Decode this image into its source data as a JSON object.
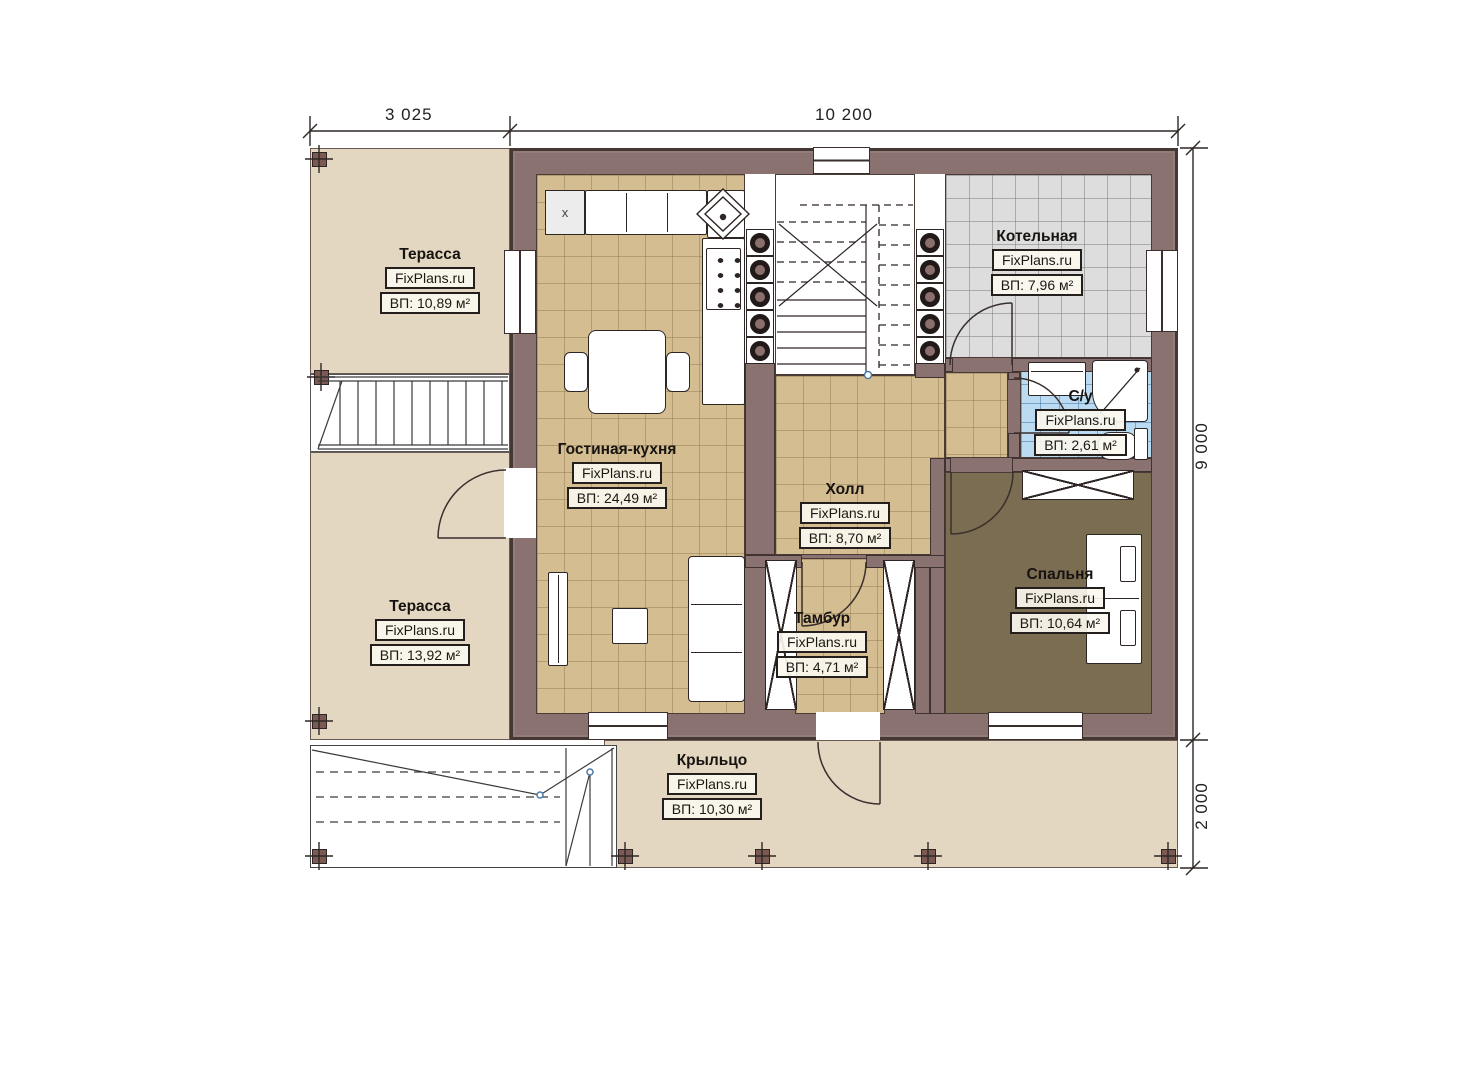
{
  "plan": {
    "watermark": "FixPlans.ru",
    "kitchen_mark": "x",
    "dims": {
      "top_left": "3 025",
      "top_right": "10 200",
      "right_upper": "9 000",
      "right_lower": "2 000"
    },
    "rooms": [
      {
        "name": "Терасса",
        "area": "ВП: 10,89 м²"
      },
      {
        "name": "Котельная",
        "area": "ВП: 7,96 м²"
      },
      {
        "name": "Гостиная-кухня",
        "area": "ВП: 24,49 м²"
      },
      {
        "name": "Холл",
        "area": "ВП: 8,70 м²"
      },
      {
        "name": "С/у",
        "area": "ВП: 2,61 м²"
      },
      {
        "name": "Терасса",
        "area": "ВП: 13,92 м²"
      },
      {
        "name": "Тамбур",
        "area": "ВП: 4,71 м²"
      },
      {
        "name": "Спальня",
        "area": "ВП: 10,64 м²"
      },
      {
        "name": "Крыльцо",
        "area": "ВП: 10,30 м²"
      }
    ],
    "colors": {
      "wall": "#8a7270",
      "wall_line": "#453734",
      "terrace": "#e4d7c1",
      "tile_tan": "#d5bd92",
      "tile_gray": "#dddddd",
      "tile_blue": "#badbf1",
      "bedroom_floor": "#7b6d52"
    }
  }
}
